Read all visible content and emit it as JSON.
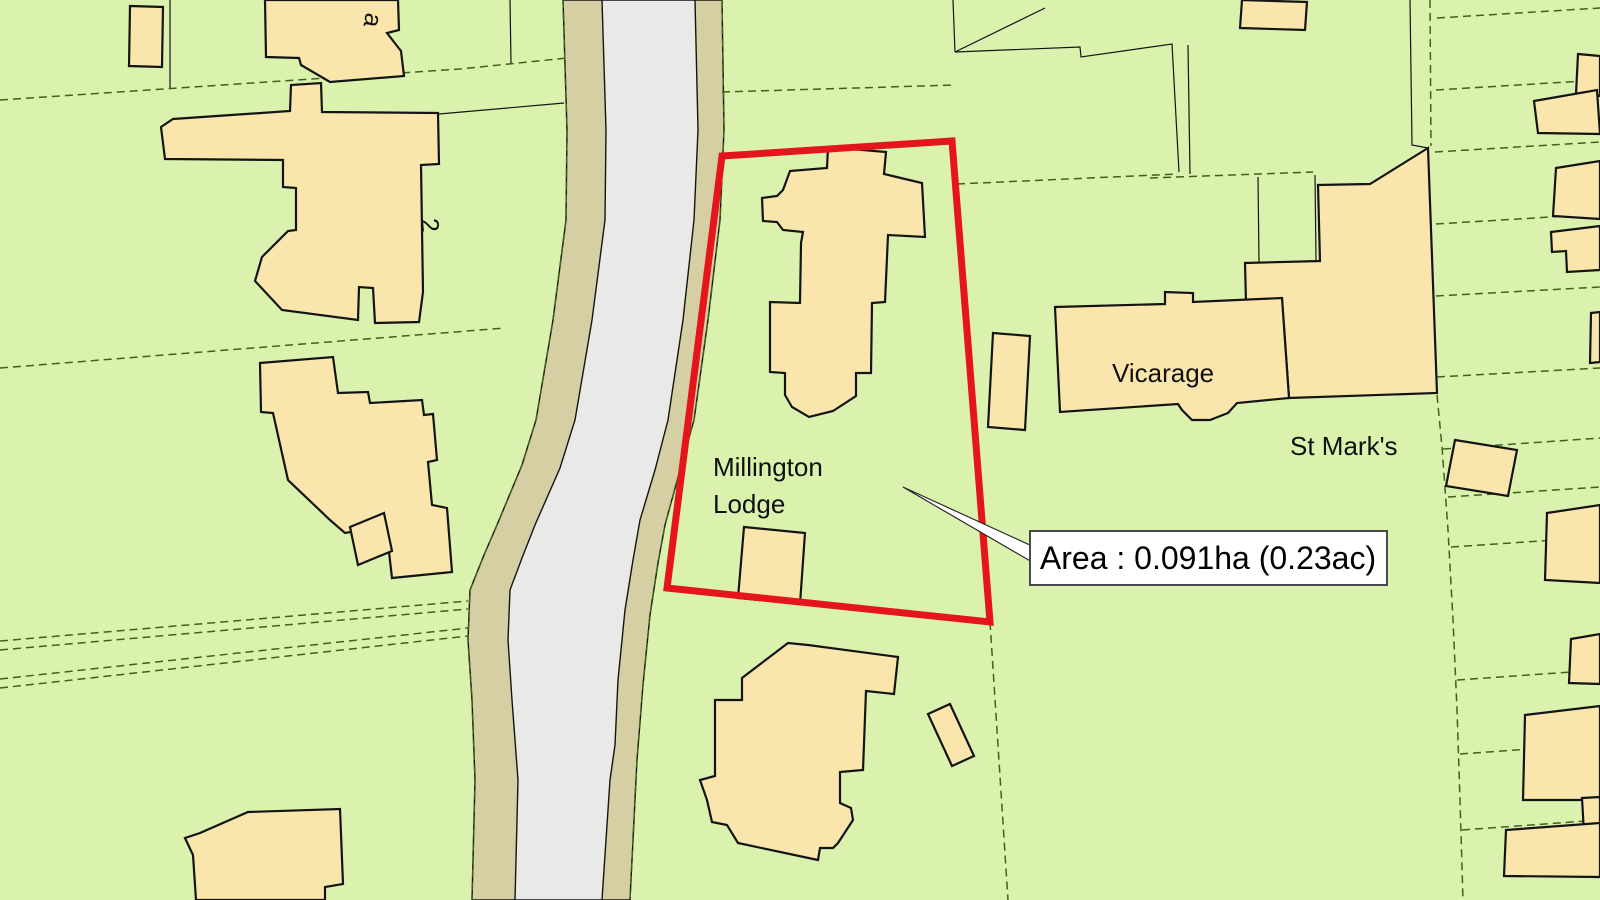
{
  "map": {
    "labels": {
      "building_letter": "a",
      "house_number": "2",
      "plot_name_line1": "Millington",
      "plot_name_line2": "Lodge",
      "vicarage": "Vicarage",
      "st_marks": "St Mark's"
    },
    "area_callout": {
      "text": "Area : 0.091ha (0.23ac)",
      "area_hectares": "0.091",
      "area_acres": "0.23"
    },
    "colors": {
      "parcel_green": "#daf2ae",
      "building_cream": "#fae6ad",
      "road_gray": "#e9e9e7",
      "verge_tan": "#d5cfa3",
      "boundary_red": "#e4151b",
      "field_line_green": "#40601e",
      "outline_black": "#141414",
      "callout_bg": "#ffffff",
      "callout_border": "#4a4a4a"
    }
  }
}
